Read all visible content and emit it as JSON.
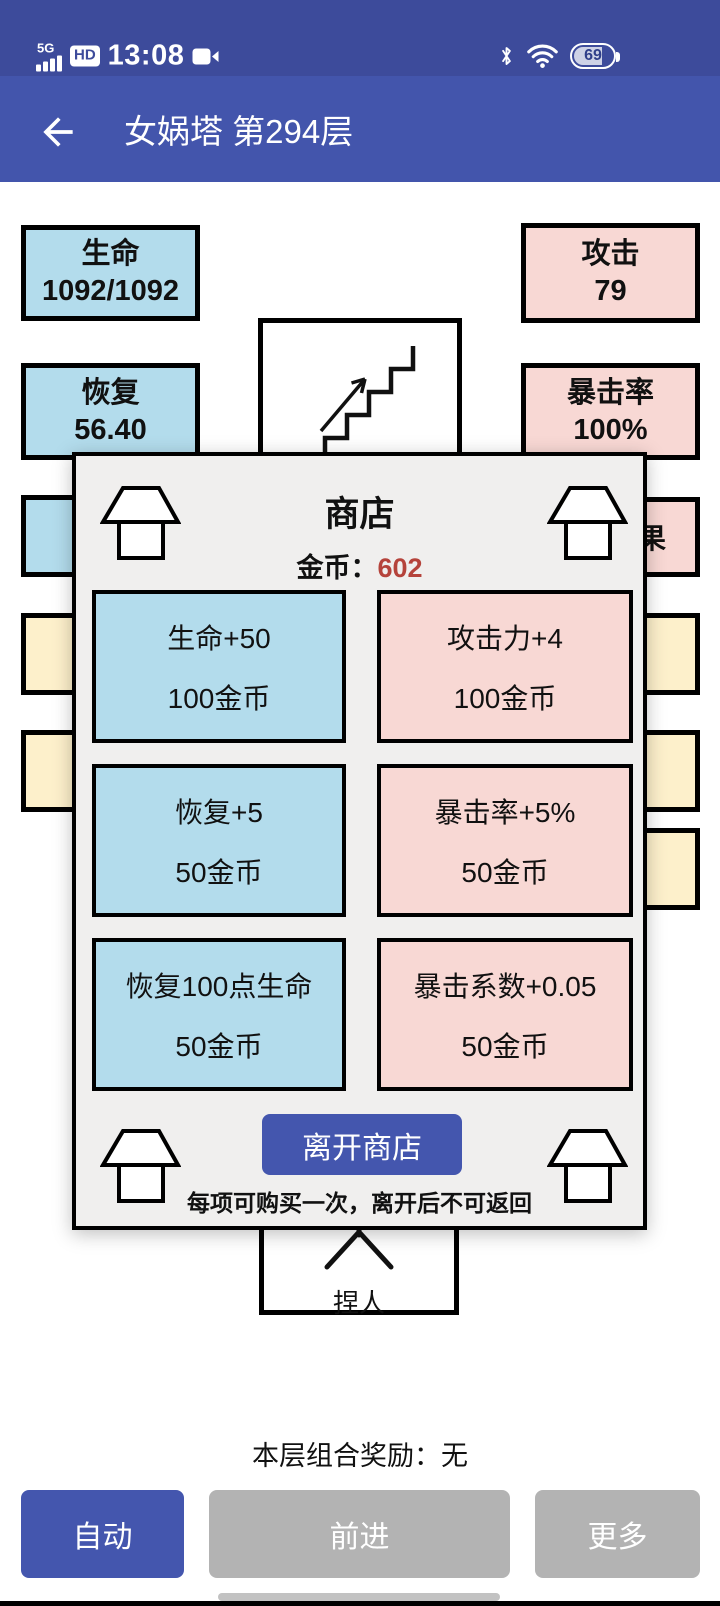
{
  "colors": {
    "status_bar_bg": "#3d4b9b",
    "app_bar_bg": "#4355ac",
    "blue_box": "#b3dcec",
    "pink_box": "#f8d8d4",
    "yellow_box": "#fdf0cb",
    "dialog_bg": "#f0efee",
    "primary_button": "#4456ae",
    "gray_button": "#b3b3b3",
    "gold_value_red": "#b5433b"
  },
  "status_bar": {
    "network": "5G",
    "hd_badge": "HD",
    "time": "13:08",
    "battery_percent": "69"
  },
  "app_bar": {
    "title": "女娲塔 第294层"
  },
  "board": {
    "stats": {
      "hp": {
        "label": "生命",
        "value": "1092/1092"
      },
      "attack": {
        "label": "攻击",
        "value": "79"
      },
      "recover": {
        "label": "恢复",
        "value": "56.40"
      },
      "crit_rate": {
        "label": "暴击率",
        "value": "100%"
      }
    },
    "fruit_room_text": "果",
    "player_room_label": "捏人"
  },
  "shop_dialog": {
    "title": "商店",
    "gold_label": "金币：",
    "gold_value": "602",
    "items": [
      {
        "name": "生命+50",
        "price": "100金币",
        "type": "blue"
      },
      {
        "name": "攻击力+4",
        "price": "100金币",
        "type": "pink"
      },
      {
        "name": "恢复+5",
        "price": "50金币",
        "type": "blue"
      },
      {
        "name": "暴击率+5%",
        "price": "50金币",
        "type": "pink"
      },
      {
        "name": "恢复100点生命",
        "price": "50金币",
        "type": "blue"
      },
      {
        "name": "暴击系数+0.05",
        "price": "50金币",
        "type": "pink"
      }
    ],
    "leave_button": "离开商店",
    "note": "每项可购买一次，离开后不可返回"
  },
  "footer": {
    "reward_text": "本层组合奖励：无",
    "buttons": [
      {
        "label": "自动",
        "style": "primary"
      },
      {
        "label": "前进",
        "style": "gray"
      },
      {
        "label": "更多",
        "style": "gray"
      }
    ]
  }
}
